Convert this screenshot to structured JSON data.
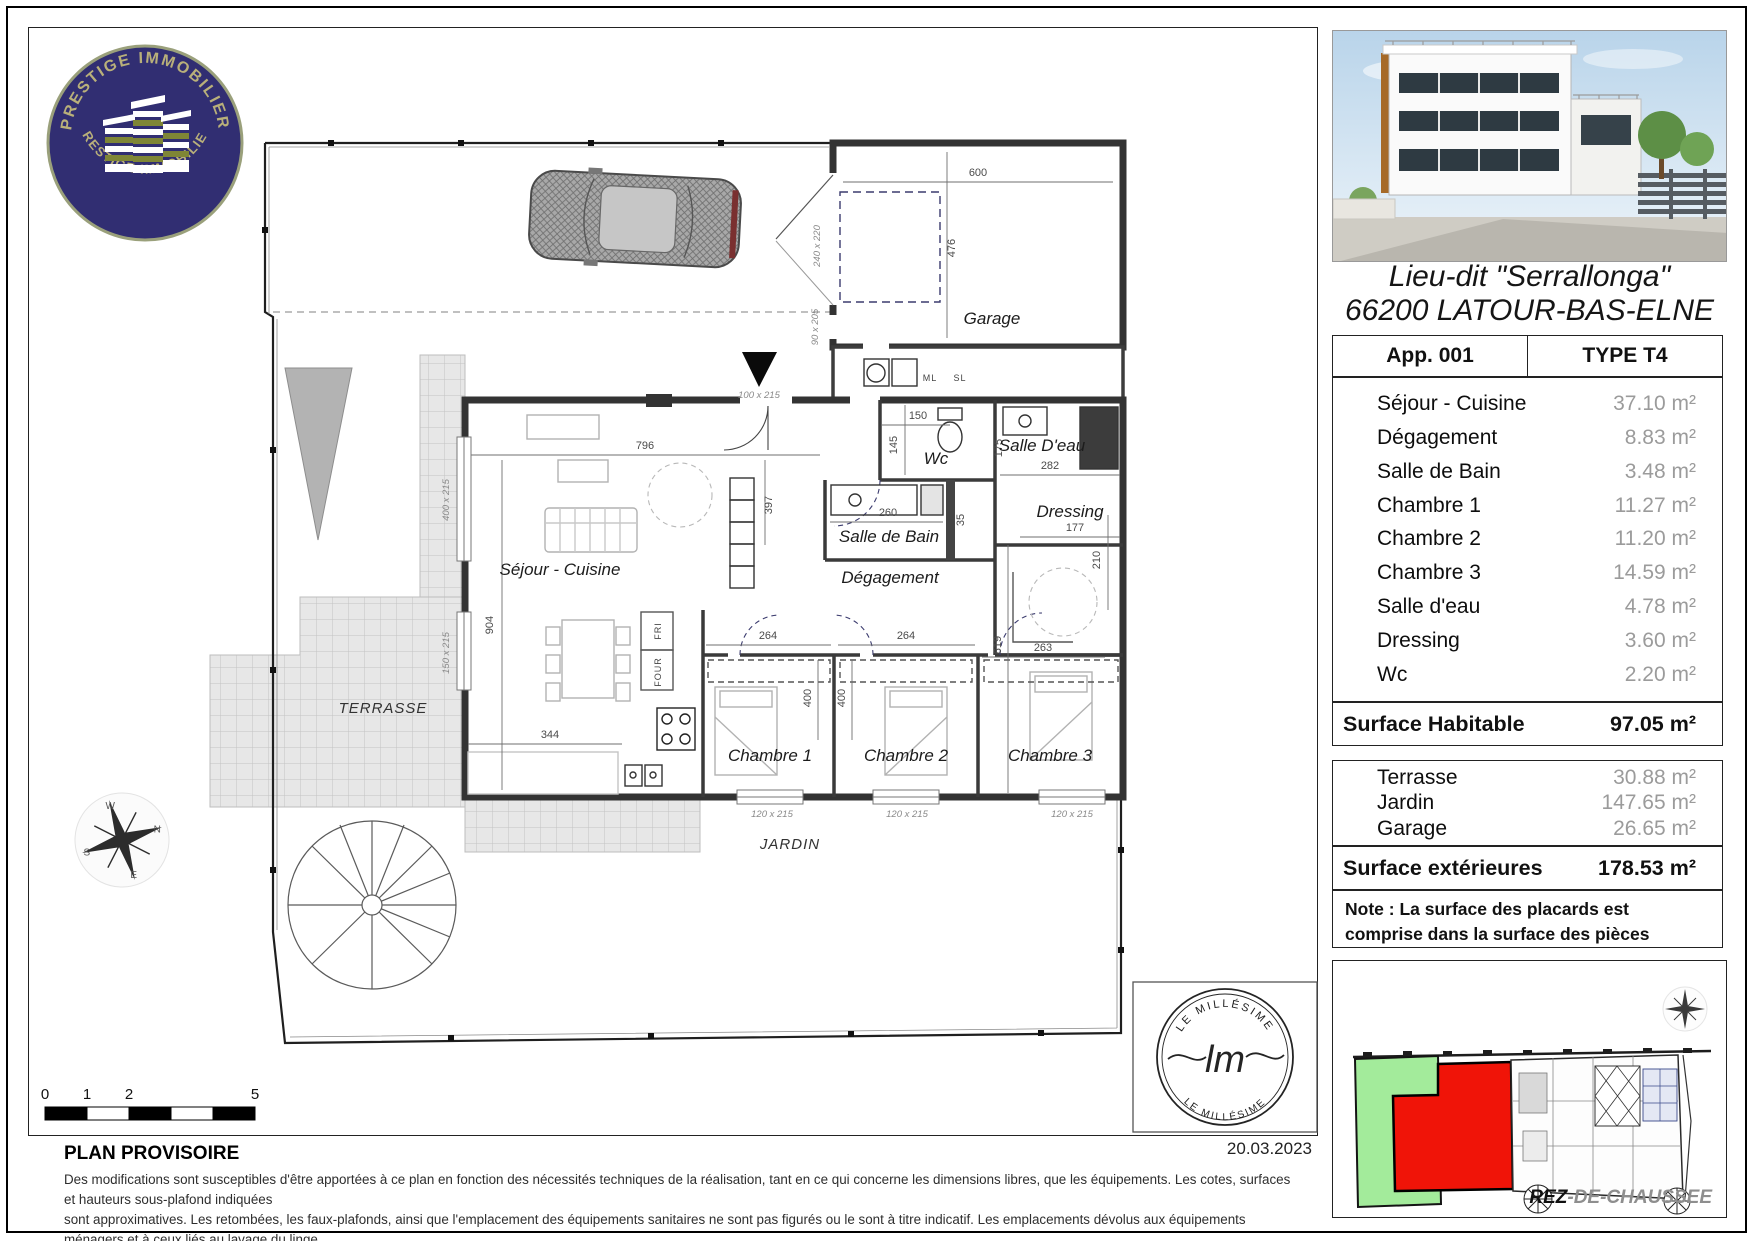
{
  "page": {
    "date": "20.03.2023"
  },
  "logo": {
    "arc_top": "PRESTIGE IMMOBILIER",
    "arc_bottom": "PRESTIGE IMMOBILIER"
  },
  "header": {
    "address_line1": "Lieu-dit \"Serrallonga\"",
    "address_line2": "66200 LATOUR-BAS-ELNE"
  },
  "apartment_table": {
    "header_left": "App. 001",
    "header_right": "TYPE T4",
    "rooms": [
      {
        "label": "Séjour - Cuisine",
        "area": "37.10 m²"
      },
      {
        "label": "Dégagement",
        "area": "8.83 m²"
      },
      {
        "label": "Salle de Bain",
        "area": "3.48 m²"
      },
      {
        "label": "Chambre 1",
        "area": "11.27 m²"
      },
      {
        "label": "Chambre 2",
        "area": "11.20 m²"
      },
      {
        "label": "Chambre 3",
        "area": "14.59 m²"
      },
      {
        "label": "Salle d'eau",
        "area": "4.78 m²"
      },
      {
        "label": "Dressing",
        "area": "3.60 m²"
      },
      {
        "label": "Wc",
        "area": "2.20 m²"
      }
    ],
    "total_label": "Surface Habitable",
    "total_value": "97.05 m²"
  },
  "exterior_table": {
    "rows": [
      {
        "label": "Terrasse",
        "area": "30.88 m²"
      },
      {
        "label": "Jardin",
        "area": "147.65 m²"
      },
      {
        "label": "Garage",
        "area": "26.65 m²"
      }
    ],
    "total_label": "Surface extérieures",
    "total_value": "178.53 m²",
    "note": "Note : La surface des placards est comprise dans la surface des pièces"
  },
  "site_plan": {
    "floor_prefix": "REZ",
    "floor_suffix": "-DE-CHAUSSEE"
  },
  "stamp": {
    "arc_top": "LE MILLÉSIME",
    "arc_bottom": "LE MILLÉSIME",
    "initials": "lm"
  },
  "scale_bar": {
    "l0": "0",
    "l1": "1",
    "l2": "2",
    "l5": "5"
  },
  "compass": {
    "n": "N",
    "s": "S",
    "e": "E",
    "w": "W"
  },
  "footer": {
    "title": "PLAN PROVISOIRE",
    "line1": "Des modifications sont susceptibles d'être apportées à ce plan en fonction des nécessités techniques de la réalisation, tant en ce qui concerne les dimensions libres, que les équipements. Les cotes, surfaces et hauteurs sous-plafond indiquées",
    "line2": "sont approximatives. Les retombées, les faux-plafonds, ainsi que l'emplacement des équipements sanitaires ne sont pas figurés ou le sont à titre indicatif. Les emplacements dévolus aux équipements ménagers et à ceux liés au lavage du linge",
    "line3": "sont représentés sur le plan de vente en correspondance avec les différents raccordements nécessaires en électricité et en eau, aucun de ces éléments n'est fourni, à l'exception de ceux indiqués au descirptif."
  },
  "plan": {
    "rooms": {
      "garage": "Garage",
      "wc": "Wc",
      "salle_deau": "Salle D'eau",
      "sdb": "Salle de Bain",
      "degagement": "Dégagement",
      "dressing": "Dressing",
      "sejour": "Séjour - Cuisine",
      "ch1": "Chambre 1",
      "ch2": "Chambre 2",
      "ch3": "Chambre 3",
      "terrasse": "TERRASSE",
      "jardin": "JARDIN",
      "ml": "ML",
      "sl": "SL",
      "four": "FOUR",
      "fri": "FRI"
    },
    "dims": {
      "d600": "600",
      "d476": "476",
      "d796": "796",
      "d397": "397",
      "d904": "904",
      "d344": "344",
      "d264a": "264",
      "d264b": "264",
      "d400a": "400",
      "d400b": "400",
      "d619": "619",
      "d263": "263",
      "d282": "282",
      "d177": "177",
      "d210": "210",
      "d175": "175",
      "d150": "150",
      "d145": "145",
      "d260": "260",
      "d35": "35",
      "w100": "100 x 215",
      "w120a": "120 x 215",
      "w120b": "120 x 215",
      "w120c": "120 x 215",
      "w400": "400 x 215",
      "w150": "150 x 215",
      "wgar": "240 x 220",
      "wside": "90 x 205"
    }
  }
}
